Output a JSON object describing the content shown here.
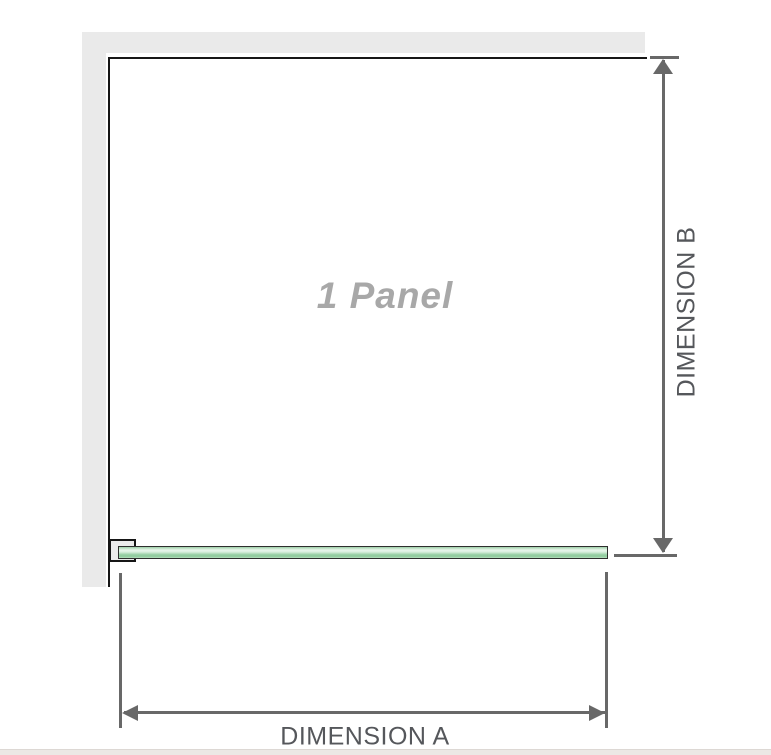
{
  "diagram": {
    "panel_label": "1 Panel",
    "dimension_a_label": "DIMENSION A",
    "dimension_b_label": "DIMENSION B"
  },
  "icons": {
    "arrow_up": "dimension-b-arrow-up-icon",
    "arrow_down": "dimension-b-arrow-down-icon",
    "arrow_left": "dimension-a-arrow-left-icon",
    "arrow_right": "dimension-a-arrow-right-icon"
  },
  "colors": {
    "wall": "#eaeaea",
    "outline": "#161616",
    "dim": "#686868",
    "dim-text": "#55575b",
    "panel-text": "#a8a8a8",
    "glass-border": "#2e2e2e",
    "glass_green_highlight": "#e9f6ec",
    "glass_green_mid": "#97cfa4",
    "strip": "#ece8e5"
  }
}
